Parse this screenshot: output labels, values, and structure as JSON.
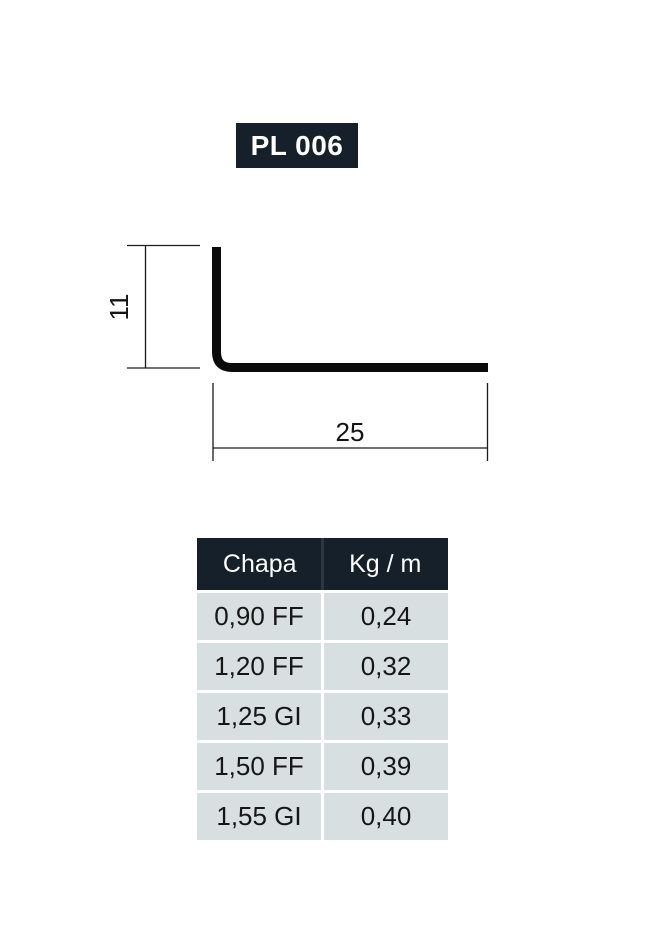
{
  "title": {
    "label": "PL 006"
  },
  "diagram": {
    "description": "L-angle profile cross-section",
    "height_dim": "11",
    "width_dim": "25"
  },
  "table": {
    "headers": [
      "Chapa",
      "Kg / m"
    ],
    "rows": [
      {
        "chapa": "0,90 FF",
        "kg": "0,24"
      },
      {
        "chapa": "1,20 FF",
        "kg": "0,32"
      },
      {
        "chapa": "1,25 GI",
        "kg": "0,33"
      },
      {
        "chapa": "1,50 FF",
        "kg": "0,39"
      },
      {
        "chapa": "1,55 GI",
        "kg": "0,40"
      }
    ]
  },
  "colors": {
    "header_bg": "#15202a",
    "row_bg": "#d8dfe0",
    "profile_stroke": "#0b0b0b"
  }
}
